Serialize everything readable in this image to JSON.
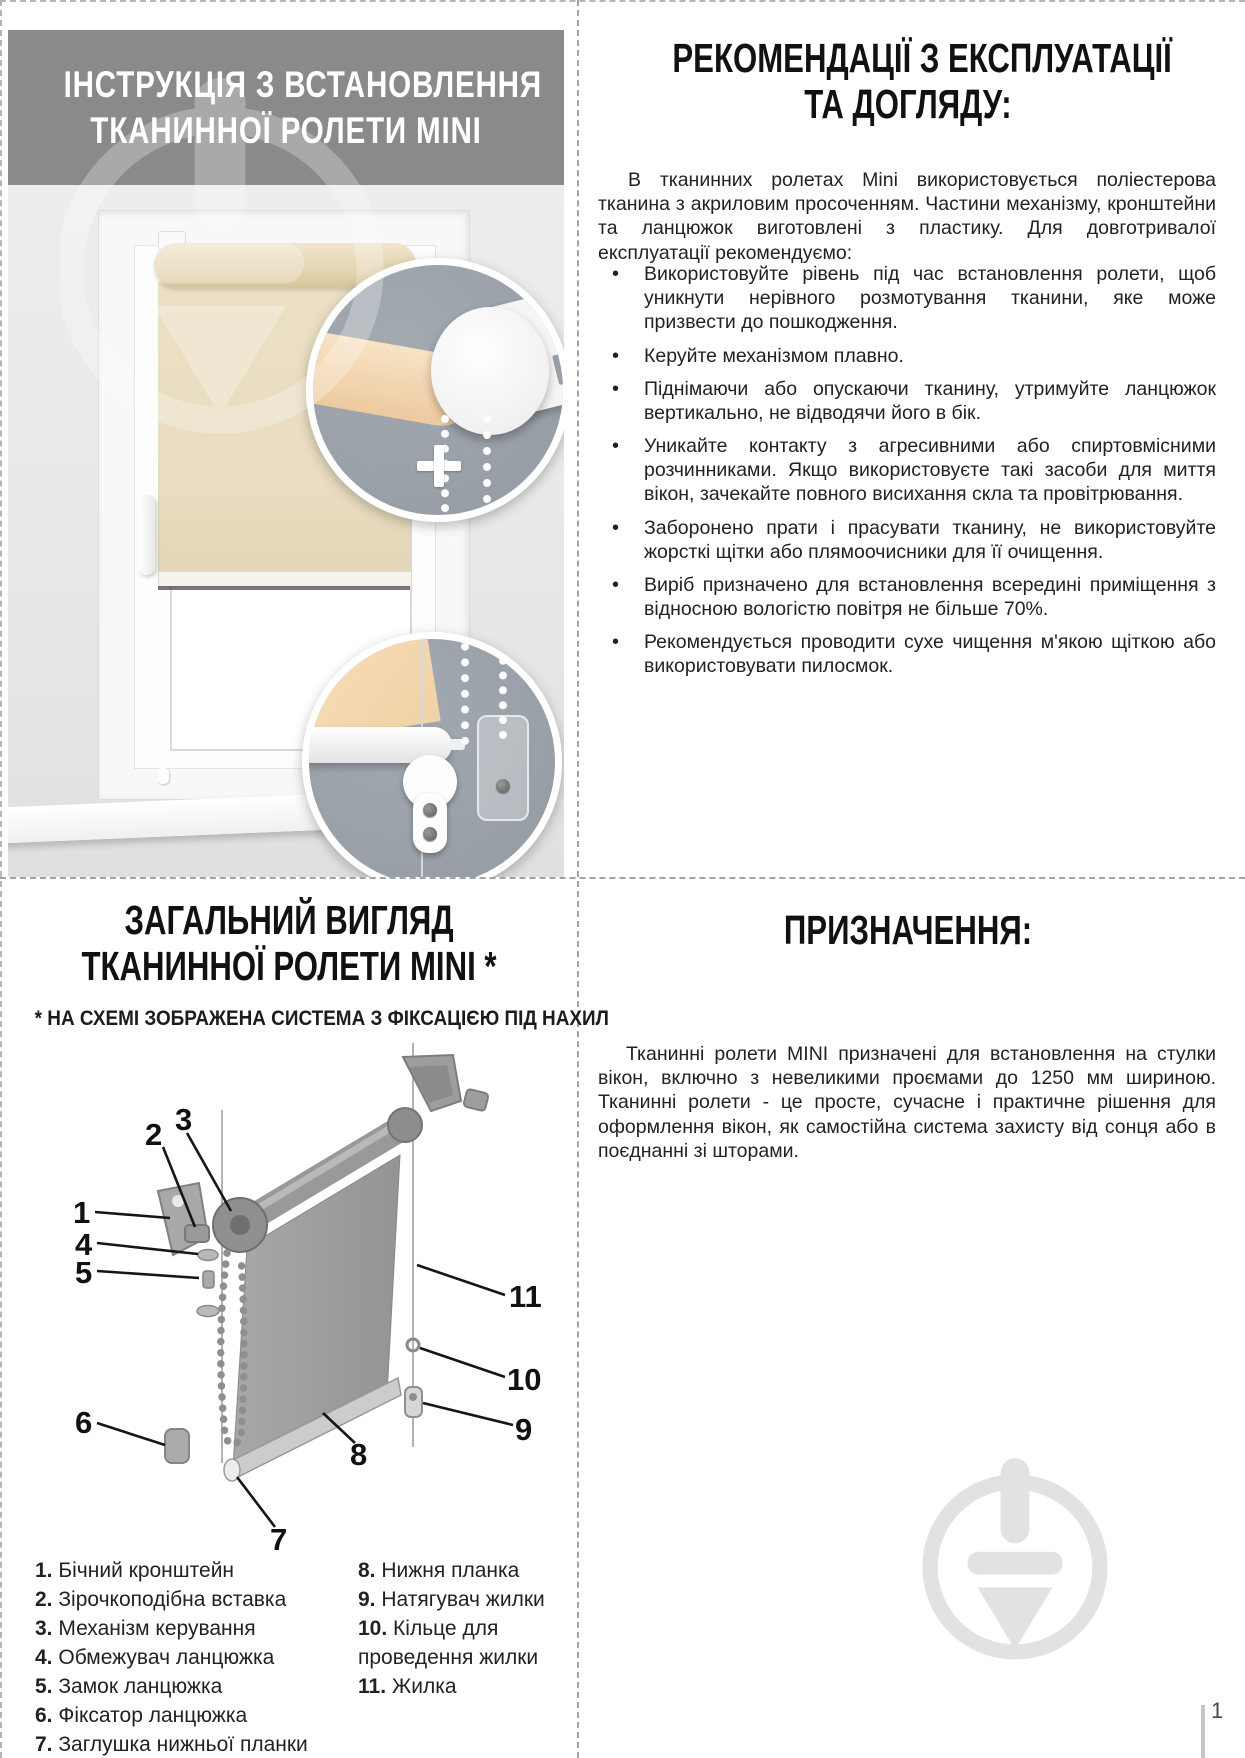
{
  "page": {
    "number": "1"
  },
  "colors": {
    "header_band": "#8a8a8a",
    "photo_background": "#e9e9e9",
    "blind_fabric": "#e9dcc0",
    "inset_background": "#99a0a8",
    "diagram_fabric": "#9f9f9f",
    "watermark": "#e2e2e2",
    "text": "#1c1c1c"
  },
  "top_left": {
    "title_line1": "ІНСТРУКЦІЯ З ВСТАНОВЛЕННЯ",
    "title_line2": "ТКАНИННОЇ РОЛЕТИ MINI"
  },
  "top_right": {
    "title_line1": "РЕКОМЕНДАЦІЇ З ЕКСПЛУАТАЦІЇ",
    "title_line2": "ТА ДОГЛЯДУ:",
    "intro": "В тканинних ролетах Mini використовується поліестерова тканина з акриловим просоченням. Частини механізму, кронштейни та ланцюжок виготовлені з пластику. Для довготривалої експлуатації рекомендуємо:",
    "bullets": [
      "Використовуйте рівень під час встановлення ролети, щоб уникнути нерівного розмотування тканини, яке може призвести до пошкодження.",
      "Керуйте механізмом плавно.",
      "Піднімаючи або опускаючи тканину, утримуйте ланцюжок вертикально, не відводячи його в бік.",
      "Уникайте контакту з агресивними або спиртовмісними розчинниками. Якщо використовуєте такі засоби для миття вікон, зачекайте повного висихання скла та провітрювання.",
      "Заборонено прати і прасувати тканину, не використовуйте жорсткі щітки або плямоочисники для її очищення.",
      "Виріб призначено для встановлення всередині приміщення з відносною вологістю повітря не більше 70%.",
      "Рекомендується проводити сухе чищення м'якою щіткою або використовувати пилосмок."
    ]
  },
  "bottom_left": {
    "title_line1": "ЗАГАЛЬНИЙ ВИГЛЯД",
    "title_line2": "ТКАНИННОЇ РОЛЕТИ MINI *",
    "subtitle": "* НА СХЕМІ ЗОБРАЖЕНА СИСТЕМА З ФІКСАЦІЄЮ ПІД НАХИЛ",
    "diagram_labels": [
      "1",
      "2",
      "3",
      "4",
      "5",
      "6",
      "7",
      "8",
      "9",
      "10",
      "11"
    ],
    "legend_col1": [
      {
        "num": "1.",
        "text": "Бічний кронштейн"
      },
      {
        "num": "2.",
        "text": "Зірочкоподібна вставка"
      },
      {
        "num": "3.",
        "text": "Механізм керування"
      },
      {
        "num": "4.",
        "text": "Обмежувач ланцюжка"
      },
      {
        "num": "5.",
        "text": "Замок ланцюжка"
      },
      {
        "num": "6.",
        "text": "Фіксатор ланцюжка"
      },
      {
        "num": "7.",
        "text": "Заглушка нижньої планки"
      }
    ],
    "legend_col2": [
      {
        "num": "8.",
        "text": "Нижня планка"
      },
      {
        "num": "9.",
        "text": "Натягувач жилки"
      },
      {
        "num": "10.",
        "text": "Кільце для проведення жилки"
      },
      {
        "num": "11.",
        "text": "Жилка"
      }
    ]
  },
  "bottom_right": {
    "title": "ПРИЗНАЧЕННЯ:",
    "body": "Тканинні ролети MINI призначені для встановлення на стулки вікон, включно з невеликими проємами до 1250 мм шириною. Тканинні ролети - це просте, сучасне і практичне рішення для оформлення вікон, як самостійна система захисту від сонця або в поєднанні зі шторами."
  }
}
